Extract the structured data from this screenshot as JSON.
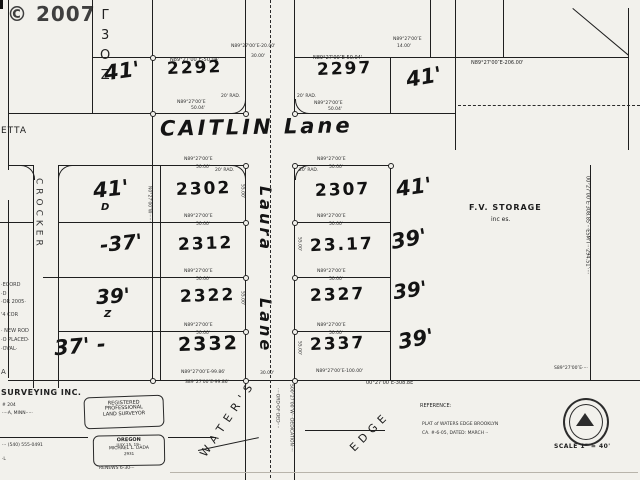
{
  "watermark": "© 2007",
  "streets": {
    "caitlin": "CAITLIN Lane",
    "laura_word1": "Laura",
    "laura_word2": "Lane",
    "crocker": "CROCKER",
    "etta": "ETTA",
    "waters": "WATER'S",
    "edge": "EDGE"
  },
  "lots": {
    "n2292": "2292",
    "n2297": "2297",
    "n2302": "2302",
    "n2307": "2307",
    "n2312": "2312",
    "n2317": "23.17",
    "n2322": "2322",
    "n2327": "2327",
    "n2332": "2332",
    "n2337": "2337"
  },
  "hand": {
    "tl": "41'",
    "l1": "41'",
    "l1b": "D",
    "l2": "-37'",
    "l3": "39'",
    "l3b": "Z",
    "l4": "37' -",
    "r0": "41'",
    "r1": "41'",
    "r2": "39'",
    "r3": "39'",
    "r4": "39'"
  },
  "vertical_chars": "Γ3OZ",
  "bearings": {
    "top_left": "N89°27'00″E-50.04'",
    "top_mid": "N89°27'00″E-20.00'",
    "top_mid2": "30.00'",
    "top_right": "N89°27'00″E-50.04'",
    "top_far": "N89°27'00″E-206.00'",
    "stub": "N89°27'00″E",
    "stub2": "14.00'",
    "row": "N89°27'00″E",
    "rowlen": "50.00'",
    "under1": "N89°27'00″E",
    "under1b": "50.04'",
    "south_w1": "N89°27'00″E-99.86'",
    "south_w2": "S89°27'00″E-99.86'",
    "south_mid": "30.00'",
    "south_e1": "N89°27'00″E-100.00'",
    "south_far": "00°27'00″E-308.8E",
    "south_far2": "S89°27'00″E····",
    "rad": "20' RAD.",
    "edge_len": "55.00'"
  },
  "storage": {
    "line1": "F.V. STORAGE",
    "line2": "inc es."
  },
  "micro_vertical": {
    "right_boundary": "00°27'00″E·308.85'···ESM'T···294.51'····",
    "col_edge": "N0°27'00″W·······",
    "road_s1": "····ORD·OF·DED····",
    "road_s2": "S00°27'00″W···DEDICATION····"
  },
  "margin_notes": [
    "·ECORD",
    "·D",
    "·OR 2005·",
    "'4 COR",
    "· NEW ROD",
    "·O PLACED·",
    "·OVAL·",
    "A"
  ],
  "surveyor": {
    "company": "SURVEYING INC.",
    "addr1": "# 204",
    "addr2": "····A, MINN·····",
    "phone": "··· (540) 555-0491",
    "tail": "·L"
  },
  "stamp_registered": {
    "l1": "REGISTERED",
    "l2": "PROFESSIONAL",
    "l3": "LAND SURVEYOR"
  },
  "stamp_oregon": {
    "l1": "OREGON",
    "l2": "JULY 15, 19··",
    "l3": "MICHAEL L. DADA",
    "l4": "2931",
    "renew": "RENEWS 6-30-··"
  },
  "reference": {
    "l1": "REFERENCE:",
    "l2": "PLAT of WATERS EDGE BROOKLYN",
    "l3": "CA. #-6-05, DATED: MARCH ··"
  },
  "scale_label": "SCALE 1″ = 40'"
}
